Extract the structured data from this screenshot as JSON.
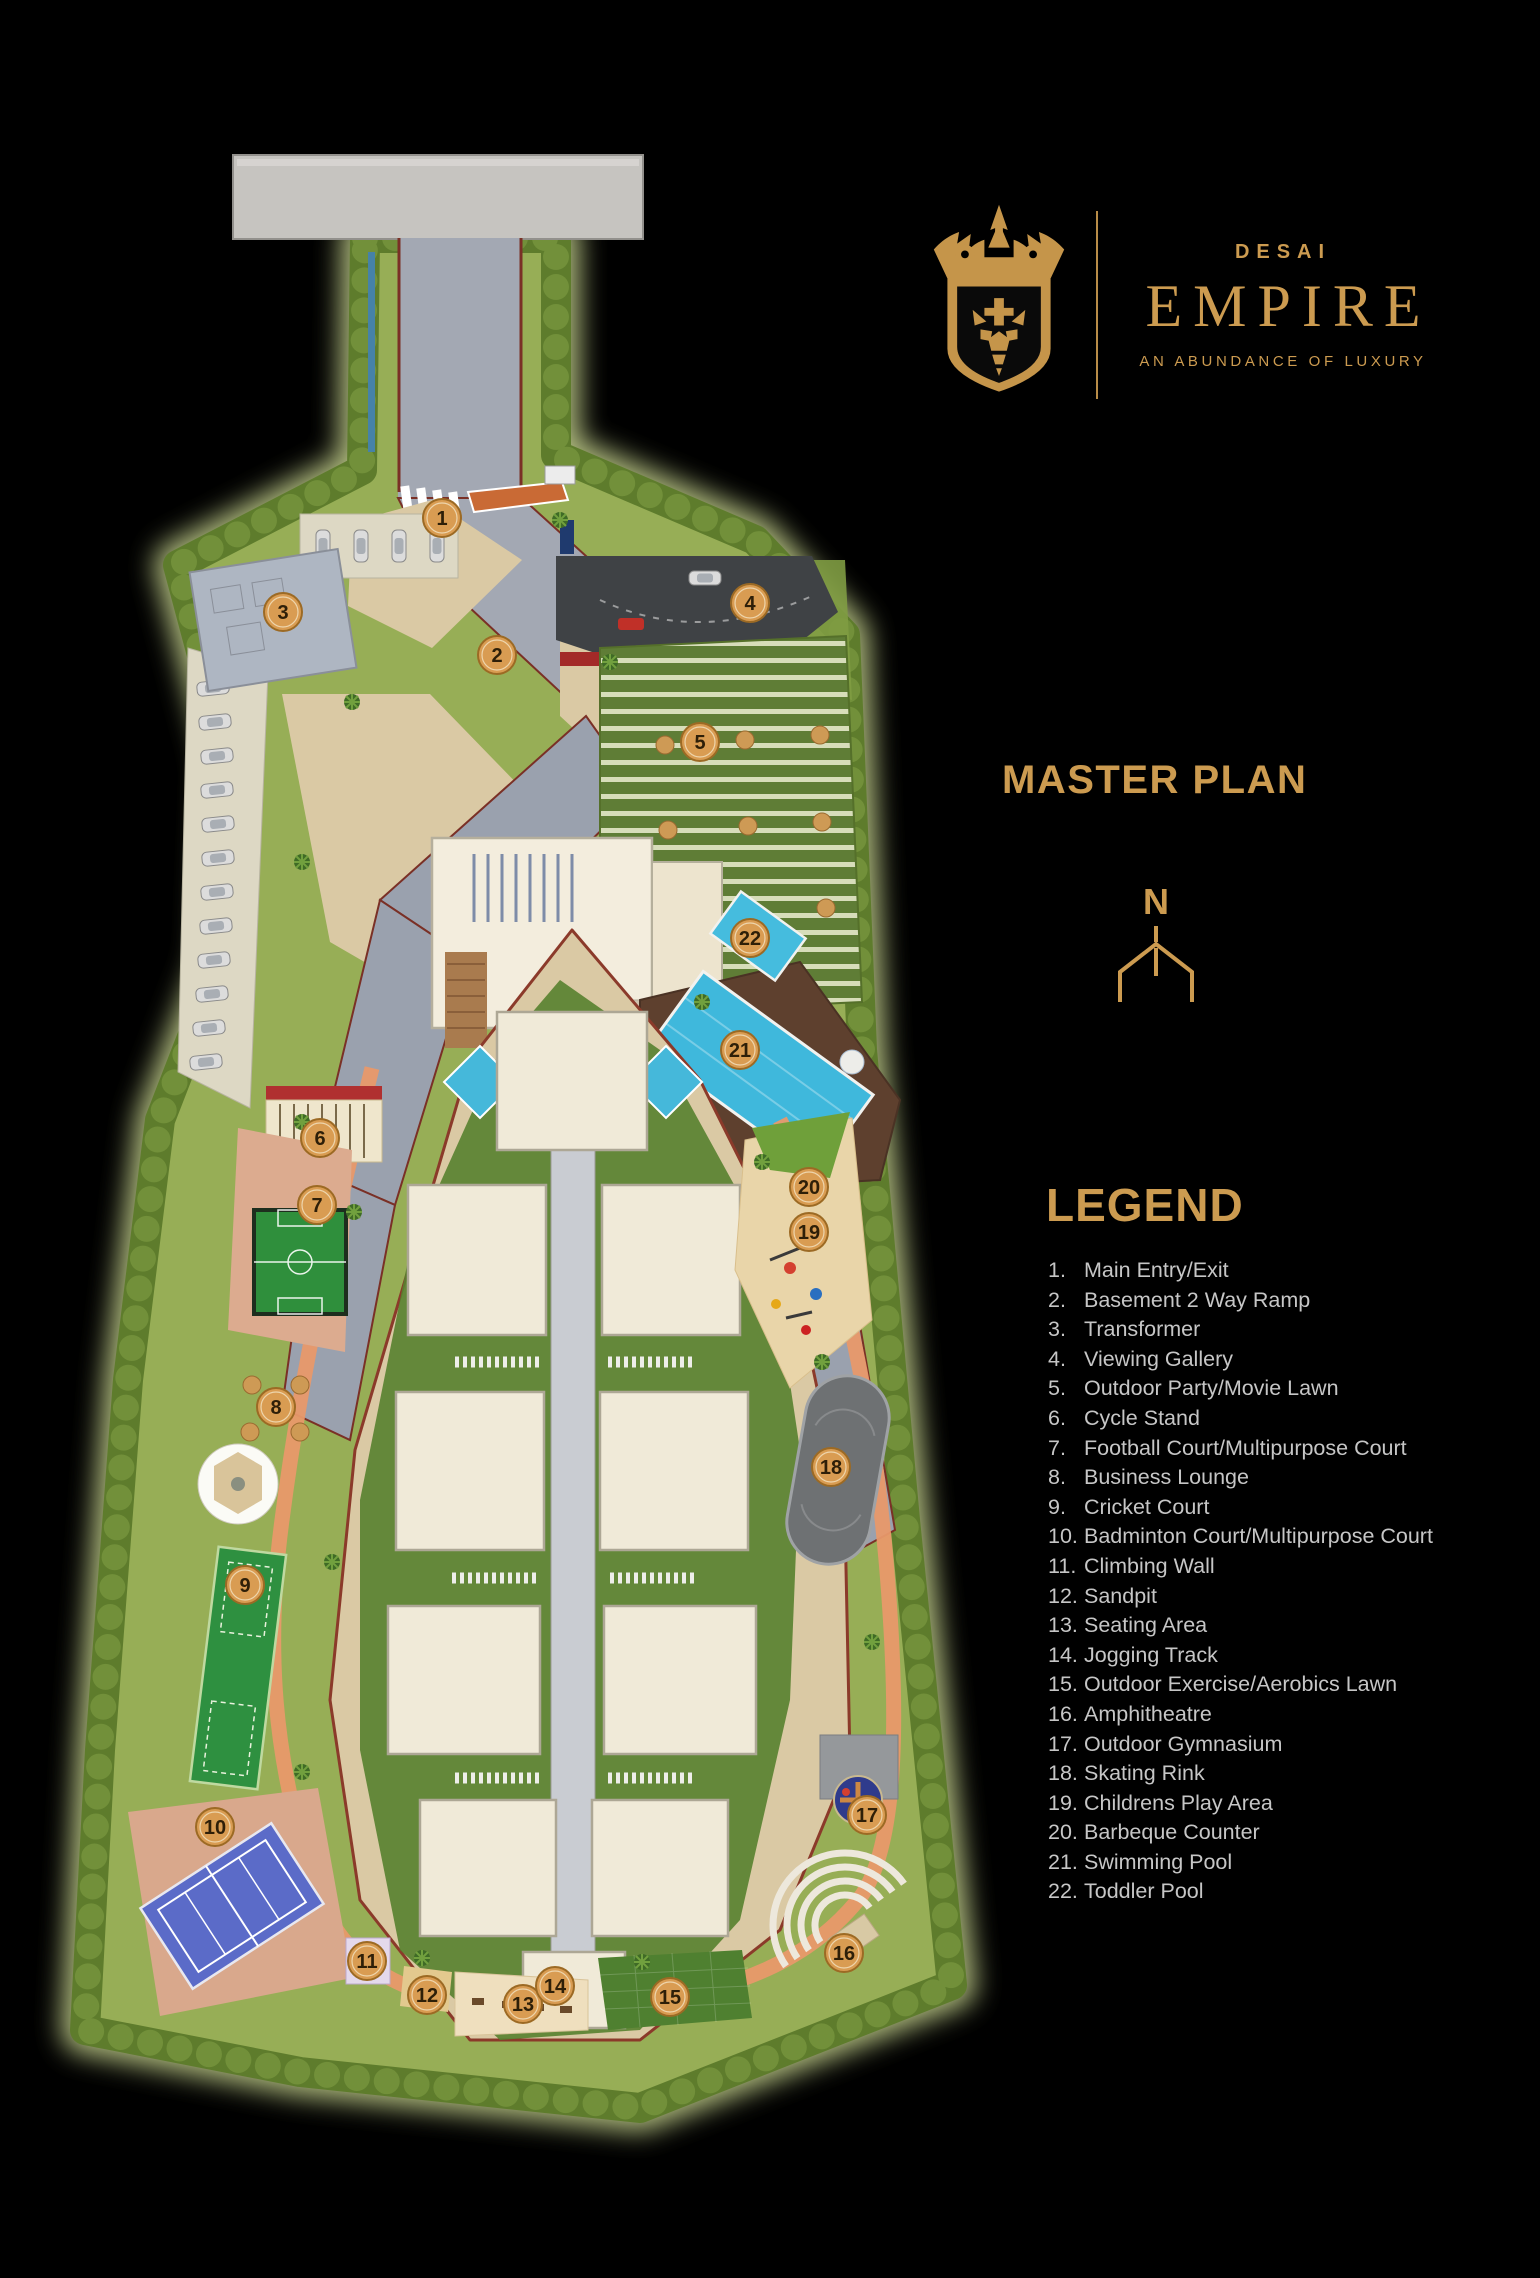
{
  "brand": {
    "name_top": "DESAI",
    "name_main": "EMPIRE",
    "tagline": "AN ABUNDANCE OF LUXURY"
  },
  "master_plan_title": "MASTER PLAN",
  "compass": {
    "north_label": "N"
  },
  "legend": {
    "title": "LEGEND",
    "items": [
      {
        "num": "1.",
        "label": "Main Entry/Exit"
      },
      {
        "num": "2.",
        "label": "Basement 2 Way Ramp"
      },
      {
        "num": "3.",
        "label": "Transformer"
      },
      {
        "num": "4.",
        "label": "Viewing Gallery"
      },
      {
        "num": "5.",
        "label": "Outdoor Party/Movie Lawn"
      },
      {
        "num": "6.",
        "label": "Cycle Stand"
      },
      {
        "num": "7.",
        "label": "Football Court/Multipurpose Court"
      },
      {
        "num": "8.",
        "label": "Business Lounge"
      },
      {
        "num": "9.",
        "label": "Cricket Court"
      },
      {
        "num": "10.",
        "label": "Badminton Court/Multipurpose Court"
      },
      {
        "num": "11.",
        "label": "Climbing Wall"
      },
      {
        "num": "12.",
        "label": "Sandpit"
      },
      {
        "num": "13.",
        "label": "Seating Area"
      },
      {
        "num": "14.",
        "label": "Jogging Track"
      },
      {
        "num": "15.",
        "label": "Outdoor Exercise/Aerobics Lawn"
      },
      {
        "num": "16.",
        "label": "Amphitheatre"
      },
      {
        "num": "17.",
        "label": "Outdoor Gymnasium"
      },
      {
        "num": "18.",
        "label": "Skating Rink"
      },
      {
        "num": "19.",
        "label": "Childrens Play Area"
      },
      {
        "num": "20.",
        "label": "Barbeque Counter"
      },
      {
        "num": "21.",
        "label": "Swimming Pool"
      },
      {
        "num": "22.",
        "label": "Toddler Pool"
      }
    ]
  },
  "map": {
    "markers": [
      {
        "num": "1",
        "x": 442,
        "y": 518
      },
      {
        "num": "2",
        "x": 497,
        "y": 655
      },
      {
        "num": "3",
        "x": 283,
        "y": 612
      },
      {
        "num": "4",
        "x": 750,
        "y": 603
      },
      {
        "num": "5",
        "x": 700,
        "y": 742
      },
      {
        "num": "6",
        "x": 320,
        "y": 1138
      },
      {
        "num": "7",
        "x": 317,
        "y": 1205
      },
      {
        "num": "8",
        "x": 276,
        "y": 1407
      },
      {
        "num": "9",
        "x": 245,
        "y": 1585
      },
      {
        "num": "10",
        "x": 215,
        "y": 1827
      },
      {
        "num": "11",
        "x": 367,
        "y": 1961
      },
      {
        "num": "12",
        "x": 427,
        "y": 1995
      },
      {
        "num": "13",
        "x": 523,
        "y": 2004
      },
      {
        "num": "14",
        "x": 555,
        "y": 1986
      },
      {
        "num": "15",
        "x": 670,
        "y": 1997
      },
      {
        "num": "16",
        "x": 844,
        "y": 1953
      },
      {
        "num": "17",
        "x": 867,
        "y": 1815
      },
      {
        "num": "18",
        "x": 831,
        "y": 1467
      },
      {
        "num": "19",
        "x": 809,
        "y": 1232
      },
      {
        "num": "20",
        "x": 809,
        "y": 1187
      },
      {
        "num": "21",
        "x": 740,
        "y": 1050
      },
      {
        "num": "22",
        "x": 750,
        "y": 938
      }
    ]
  },
  "colors": {
    "gold": "#CC9B50",
    "legend-text": "#C6C6C6",
    "marker-fill": "#D99C52",
    "marker-border": "#9C6A24",
    "marker-ring": "#F1DFBC",
    "marker-text": "#2E1F08",
    "hedge": "#5E7C2C",
    "lawn": "#97AE56",
    "glow": "#D9E79B",
    "pool-blue": "#3FB8DC",
    "track-salmon": "#E8996A"
  }
}
